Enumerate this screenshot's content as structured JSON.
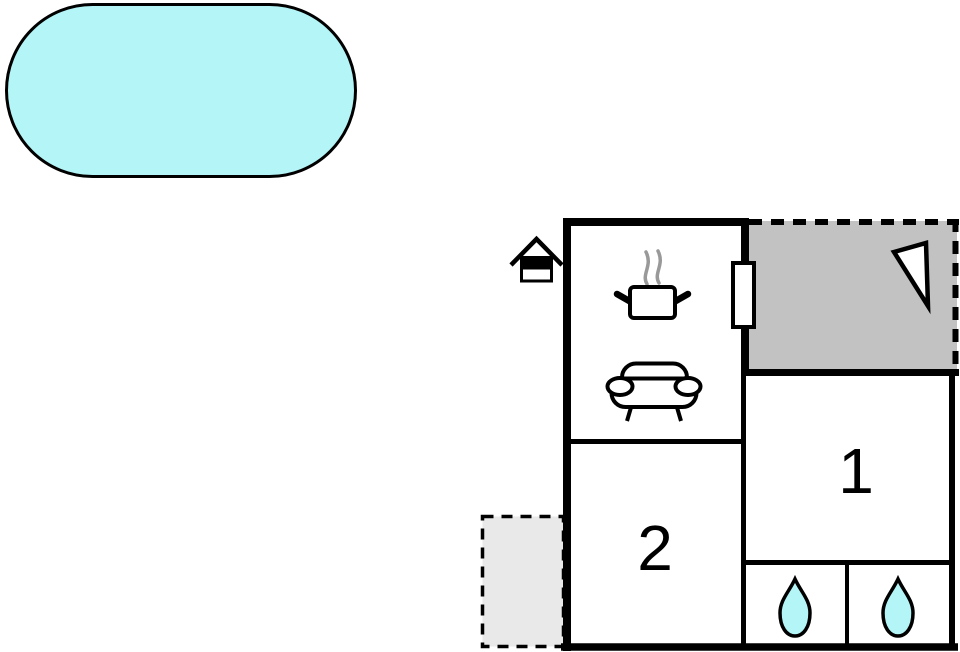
{
  "floorplan": {
    "rooms": {
      "bedroom_1": {
        "label": "1"
      },
      "bedroom_2": {
        "label": "2"
      }
    },
    "colors": {
      "pool": "#b4f5f8",
      "water_drop": "#b4f5f8",
      "terrace": "#c2c2c2",
      "annex": "#e9e9e9",
      "wall": "#000000",
      "steam": "#999999"
    },
    "icons": {
      "pool": "swimming-pool",
      "entrance": "house-entrance-icon",
      "stove": "steaming-pot-icon",
      "sofa": "sofa-icon",
      "door": "door-opening",
      "north_arrow": "north-arrow-icon",
      "bath_left": "water-drop-icon",
      "bath_right": "water-drop-icon"
    }
  }
}
